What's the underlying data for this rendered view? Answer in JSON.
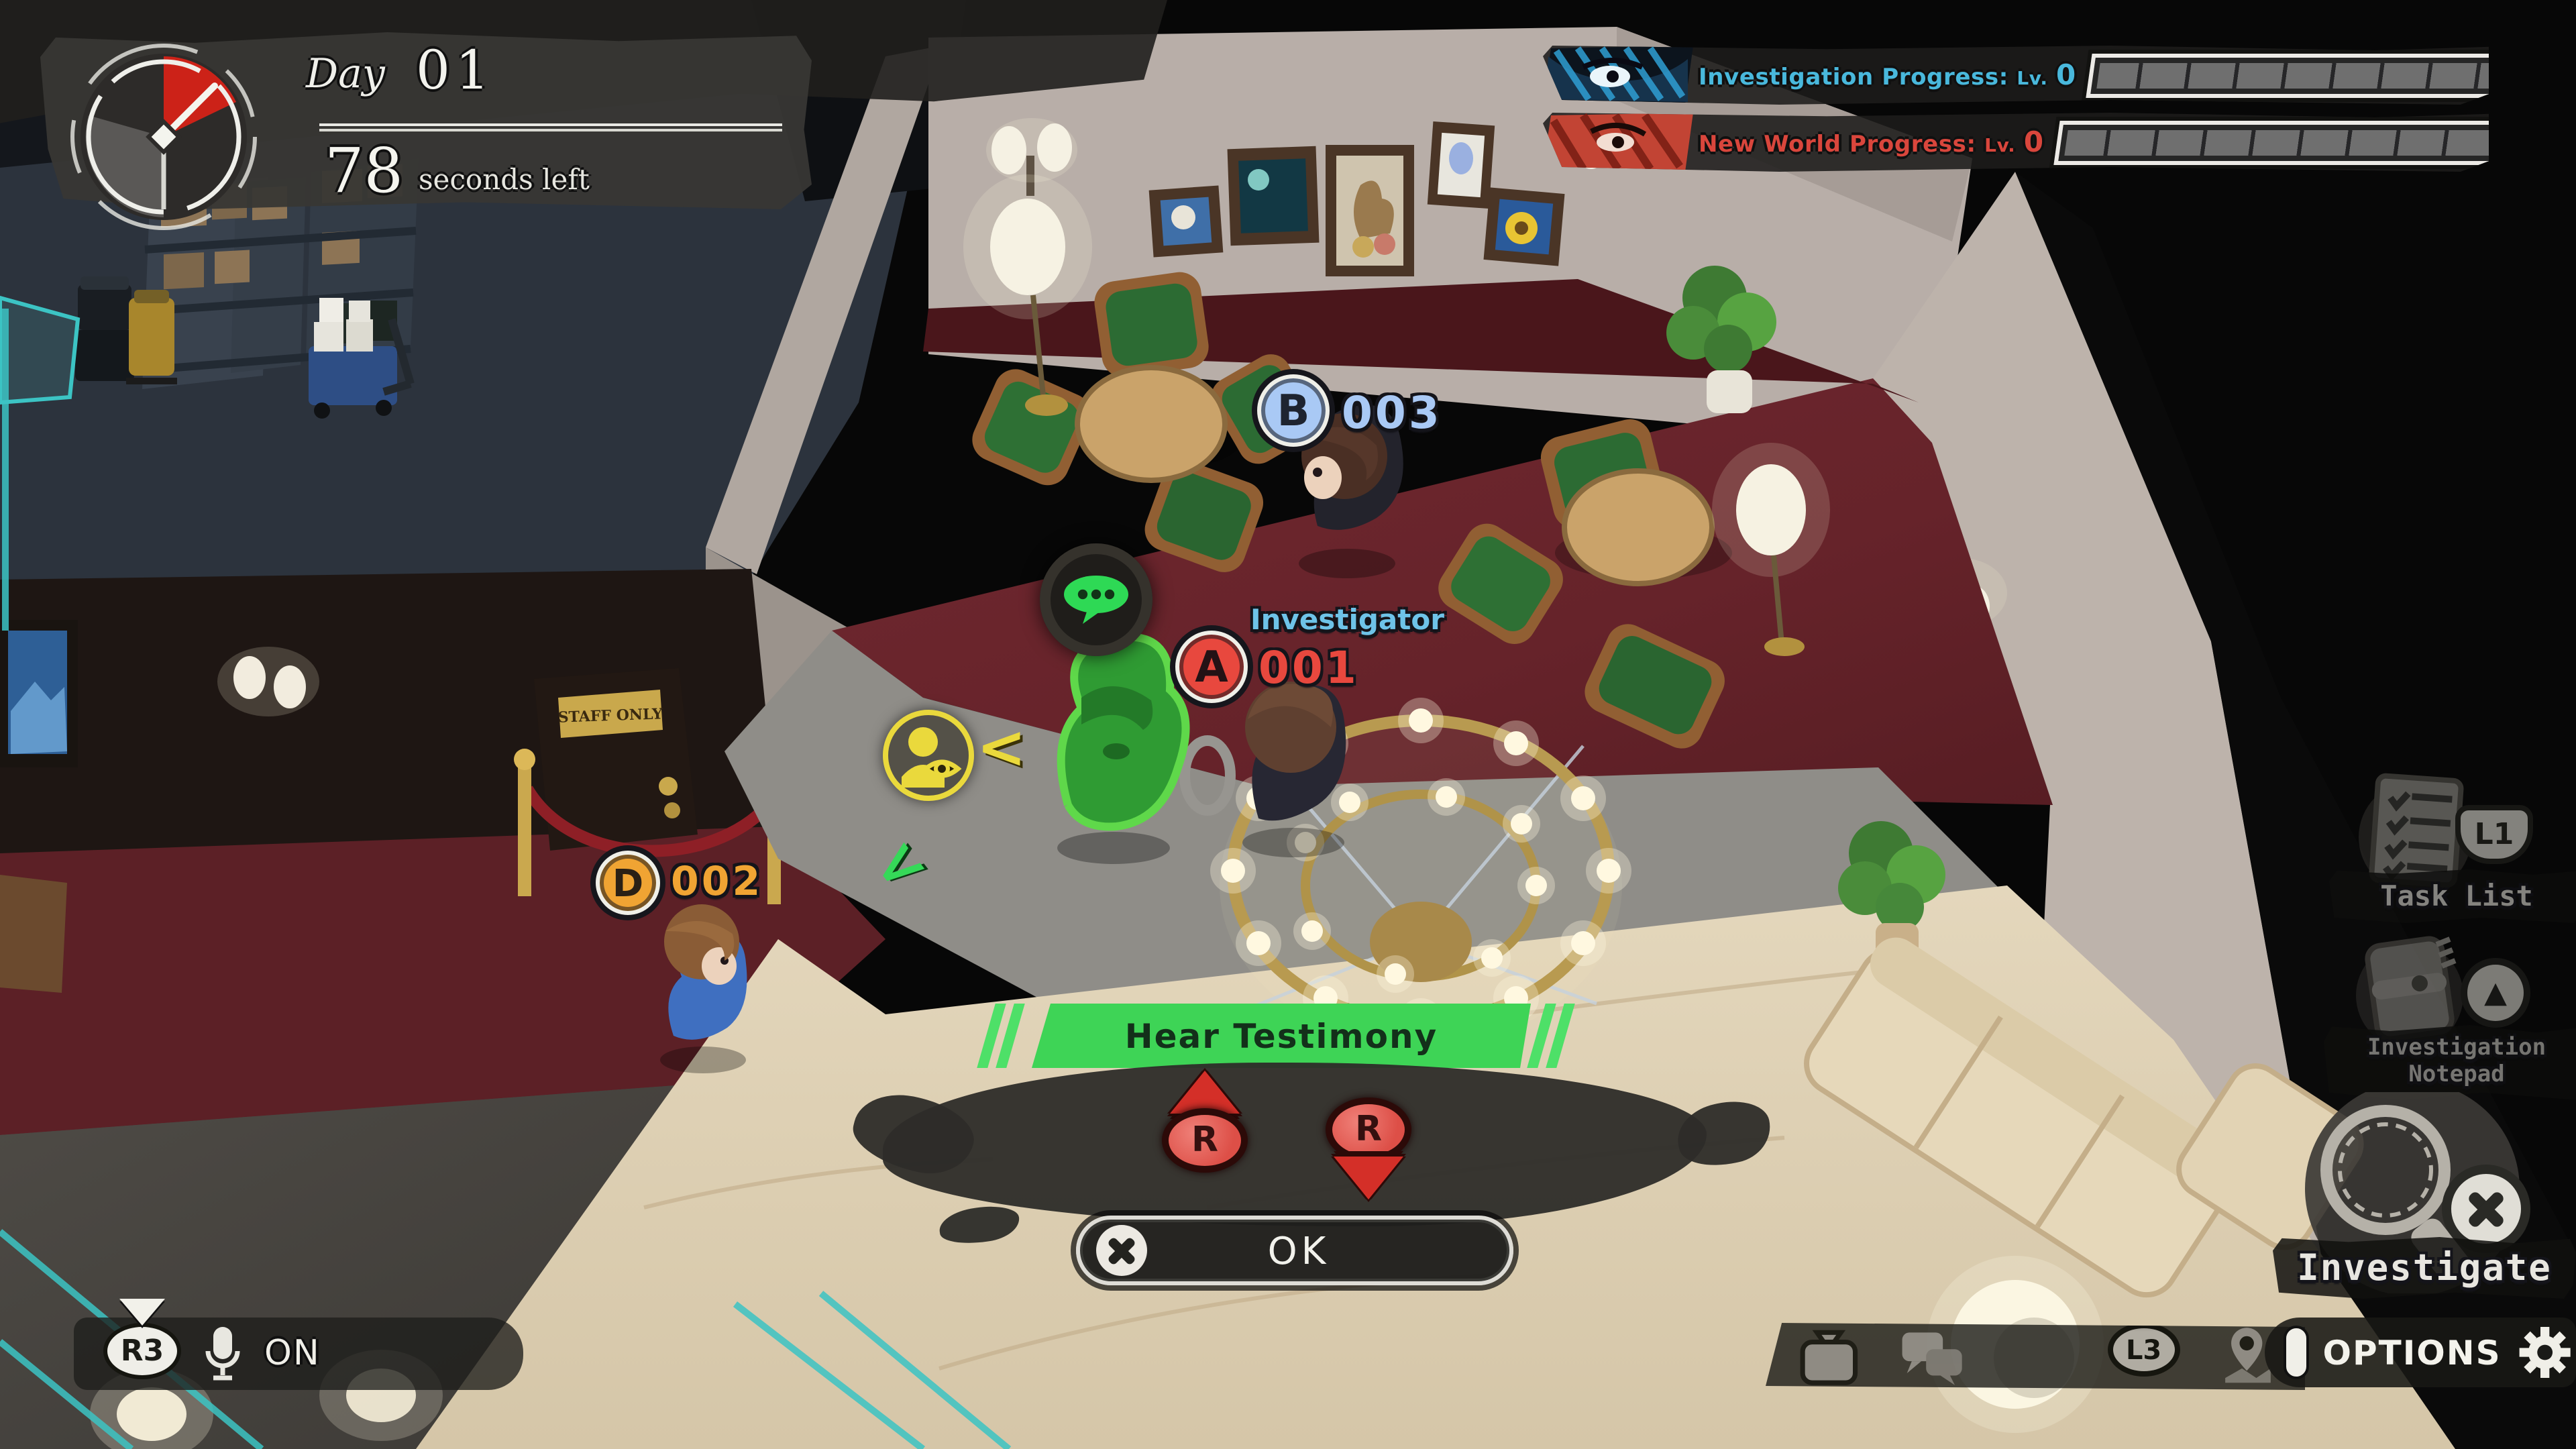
{
  "hud": {
    "timer": {
      "day_label": "Day",
      "day_value": "01",
      "seconds_value": "78",
      "seconds_label": "seconds left"
    },
    "progress_rows": [
      {
        "label": "Investigation Progress:",
        "level_prefix": "Lv.",
        "level": "0",
        "accent": "#49b8dc"
      },
      {
        "label": "New World Progress:",
        "level_prefix": "Lv.",
        "level": "0",
        "accent": "#d9463c"
      }
    ],
    "voice": {
      "button": "R3",
      "status": "ON"
    },
    "buttons": {
      "task_list_button": "L1",
      "stick_button": "L3"
    },
    "options_label": "OPTIONS"
  },
  "shortcuts": {
    "task_list": "Task List",
    "notepad_line1": "Investigation",
    "notepad_line2": "Notepad",
    "investigate": "Investigate"
  },
  "nameplates": {
    "b": {
      "letter": "B",
      "number": "003"
    },
    "a": {
      "letter": "A",
      "number": "001",
      "title": "Investigator"
    },
    "d": {
      "letter": "D",
      "number": "002"
    }
  },
  "action_prompt": {
    "title": "Hear Testimony",
    "r_left": "R",
    "r_right": "R",
    "ok": "OK"
  },
  "scene": {
    "door_sign": "STAFF ONLY"
  },
  "colors": {
    "investigation_accent": "#49b8dc",
    "new_world_accent": "#d9463c",
    "suspect_b": "#a9c9f5",
    "investigator_a": "#e8483e",
    "suspect_d": "#f0a433",
    "prompt_green": "#3ed456",
    "hud_teal": "#39c8c8"
  }
}
